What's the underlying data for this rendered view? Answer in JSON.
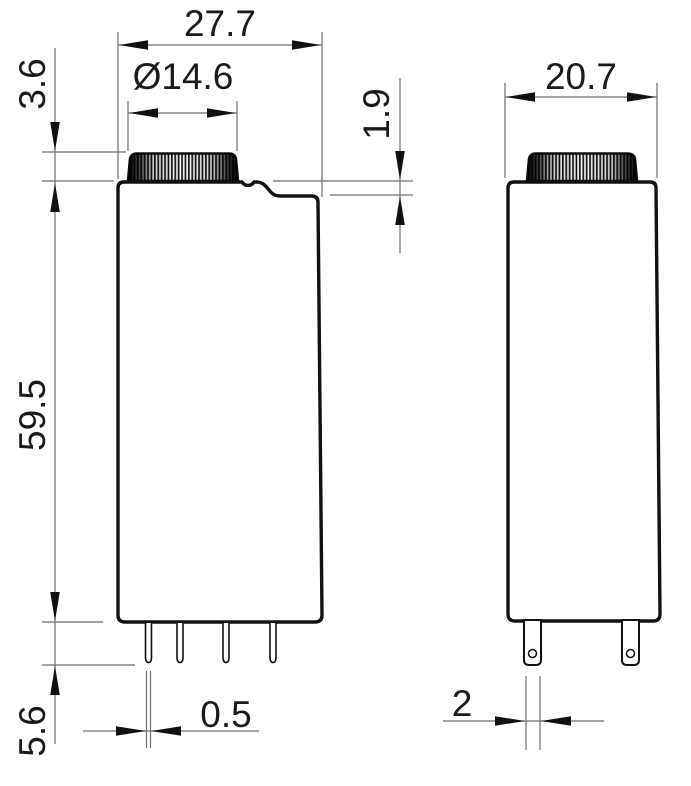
{
  "front_view": {
    "overall_width": "27.7",
    "knob_diameter": "Ø14.6",
    "knob_height": "3.6",
    "body_height": "59.5",
    "pin_length": "5.6",
    "pin_width": "0.5",
    "shoulder_step": "1.9"
  },
  "side_view": {
    "overall_width": "20.7",
    "pin_width": "2"
  },
  "colors": {
    "outline": "#111111",
    "thin_line": "#6e6e6e",
    "background": "#ffffff"
  }
}
